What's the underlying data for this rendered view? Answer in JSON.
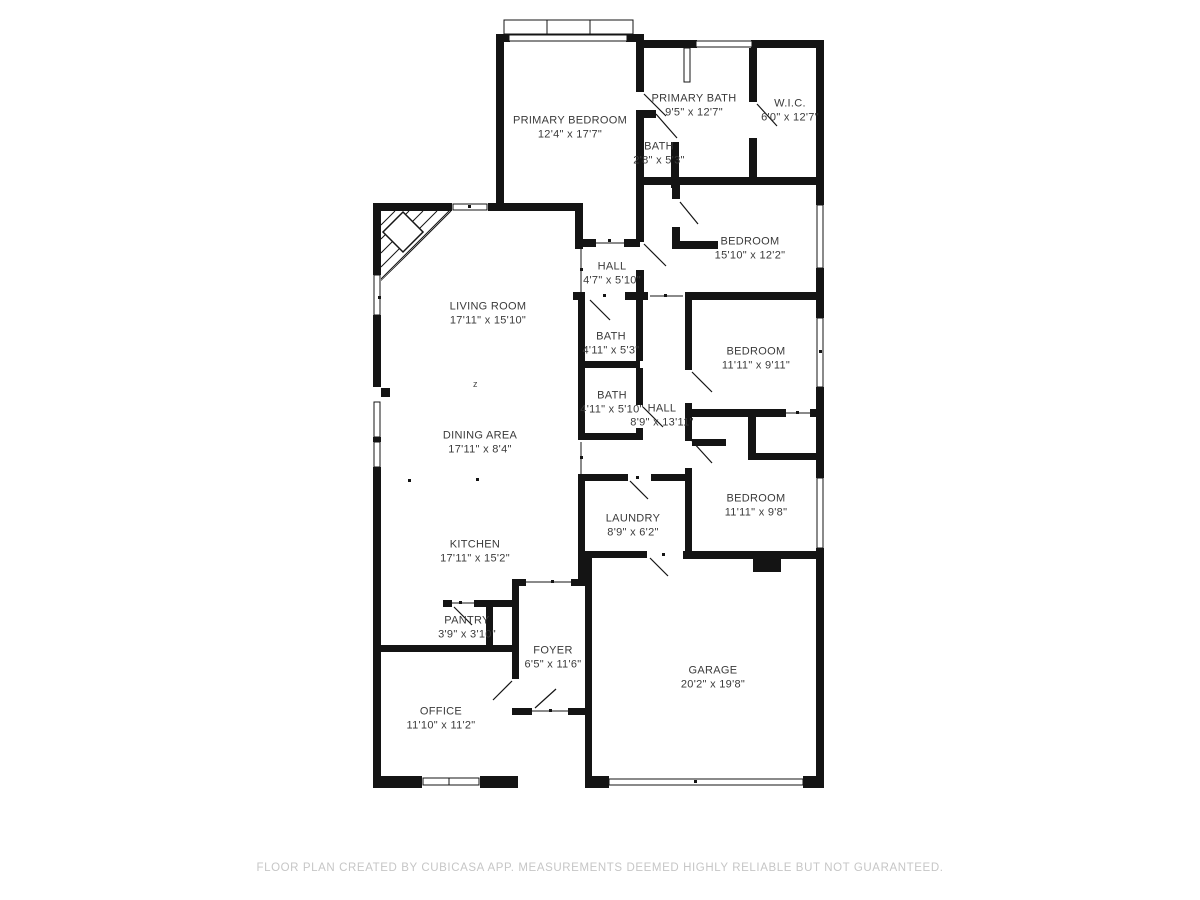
{
  "footer": {
    "text": "FLOOR PLAN CREATED BY CUBICASA APP. MEASUREMENTS DEEMED HIGHLY RELIABLE BUT NOT GUARANTEED."
  },
  "annotations": {
    "compass_z": "z"
  },
  "colors": {
    "wall": "#141414",
    "label": "#3a3a3a",
    "footer": "#c6c6c6",
    "background": "#ffffff"
  },
  "rooms": [
    {
      "id": "primary-bedroom",
      "name": "PRIMARY BEDROOM",
      "dims": "12'4\" x 17'7\"",
      "x": 570,
      "y": 128
    },
    {
      "id": "primary-bath",
      "name": "PRIMARY BATH",
      "dims": "9'5\" x 12'7\"",
      "x": 694,
      "y": 106
    },
    {
      "id": "wic",
      "name": "W.I.C.",
      "dims": "6'0\" x 12'7\"",
      "x": 790,
      "y": 111
    },
    {
      "id": "bath-small",
      "name": "BATH",
      "dims": "2'8\" x 5'3\"",
      "x": 659,
      "y": 154
    },
    {
      "id": "bedroom-1",
      "name": "BEDROOM",
      "dims": "15'10\" x 12'2\"",
      "x": 750,
      "y": 249
    },
    {
      "id": "hall-1",
      "name": "HALL",
      "dims": "4'7\" x 5'10\"",
      "x": 612,
      "y": 274
    },
    {
      "id": "living-room",
      "name": "LIVING ROOM",
      "dims": "17'11\" x 15'10\"",
      "x": 488,
      "y": 314
    },
    {
      "id": "bath-1",
      "name": "BATH",
      "dims": "4'11\" x 5'3\"",
      "x": 611,
      "y": 344
    },
    {
      "id": "bedroom-2",
      "name": "BEDROOM",
      "dims": "11'11\" x 9'11\"",
      "x": 756,
      "y": 359
    },
    {
      "id": "bath-2",
      "name": "BATH",
      "dims": "4'11\" x 5'10\"",
      "x": 612,
      "y": 403
    },
    {
      "id": "hall-2",
      "name": "HALL",
      "dims": "8'9\" x 13'11\"",
      "x": 662,
      "y": 416
    },
    {
      "id": "dining-area",
      "name": "DINING AREA",
      "dims": "17'11\" x 8'4\"",
      "x": 480,
      "y": 443
    },
    {
      "id": "bedroom-3",
      "name": "BEDROOM",
      "dims": "11'11\" x 9'8\"",
      "x": 756,
      "y": 506
    },
    {
      "id": "laundry",
      "name": "LAUNDRY",
      "dims": "8'9\" x 6'2\"",
      "x": 633,
      "y": 526
    },
    {
      "id": "kitchen",
      "name": "KITCHEN",
      "dims": "17'11\" x 15'2\"",
      "x": 475,
      "y": 552
    },
    {
      "id": "pantry",
      "name": "PANTRY",
      "dims": "3'9\" x 3'10\"",
      "x": 467,
      "y": 628
    },
    {
      "id": "foyer",
      "name": "FOYER",
      "dims": "6'5\" x 11'6\"",
      "x": 553,
      "y": 658
    },
    {
      "id": "garage",
      "name": "GARAGE",
      "dims": "20'2\" x 19'8\"",
      "x": 713,
      "y": 678
    },
    {
      "id": "office",
      "name": "OFFICE",
      "dims": "11'10\" x 11'2\"",
      "x": 441,
      "y": 719
    }
  ]
}
